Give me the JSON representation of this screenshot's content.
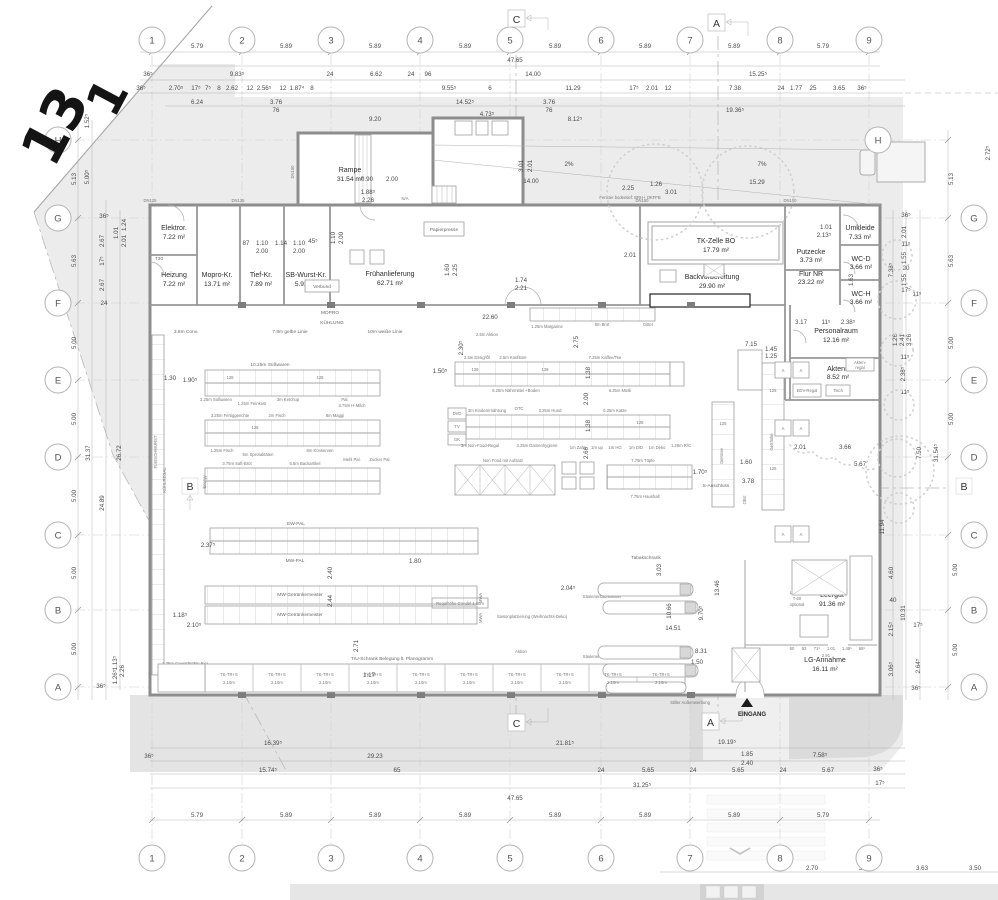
{
  "sheet": {
    "big_marks": [
      "13",
      "1"
    ],
    "markers": {
      "c": "C",
      "a": "A",
      "b": "B"
    },
    "entrance": "EINGANG",
    "notes": {
      "outdoor": "Stiller Außenwerbung",
      "fenster": "Fenster bodentief: BRH+ OKFFB",
      "dn125": "DN125",
      "dn150": "DN150",
      "t30": "T30",
      "na": "N/A"
    }
  },
  "grid": {
    "cols": [
      "1",
      "2",
      "3",
      "4",
      "5",
      "6",
      "7",
      "8",
      "9"
    ],
    "rows": [
      "H",
      "G",
      "F",
      "E",
      "D",
      "C",
      "B",
      "A"
    ]
  },
  "rooms": {
    "elektro": {
      "n": "Elektror.",
      "a": "7.22 m²"
    },
    "heizung": {
      "n": "Heizung",
      "a": "7.22 m²"
    },
    "mopro": {
      "n": "Mopro-Kr.",
      "a": "13.71 m²"
    },
    "tief": {
      "n": "Tief-Kr.",
      "a": "7.89 m²"
    },
    "sbwurst": {
      "n": "SB-Wurst-Kr.",
      "a": "5.92 m²"
    },
    "frueh": {
      "n": "Frühanlieferung",
      "a": "62.71 m²"
    },
    "rampe": {
      "n": "Rampe",
      "a": "31.54 m²"
    },
    "tkzelle": {
      "n": "TK-Zelle BO",
      "a": "17.79 m²"
    },
    "backvor": {
      "n": "Backvorbereitung",
      "a": "29.90 m²"
    },
    "putzecke": {
      "n": "Putzecke",
      "a": "3.73 m²"
    },
    "umkleide": {
      "n": "Umkleide",
      "a": "7.33 m²"
    },
    "wcd": {
      "n": "WC-D",
      "a": "3.66 m²"
    },
    "wch": {
      "n": "WC-H",
      "a": "3.66 m²"
    },
    "flur": {
      "n": "Flur NR",
      "a": "23.22 m²"
    },
    "personal": {
      "n": "Personalraum",
      "a": "12.16 m²"
    },
    "akten": {
      "n": "Aktenr.",
      "a": "8.52 m²"
    },
    "leergut": {
      "n": "Leergut",
      "a": "91.36 m²"
    },
    "lg": {
      "n": "LG-Annahme",
      "a": "16.11 m²"
    }
  },
  "fixtures": {
    "papierpresse": "Papierpresse",
    "verbund": "Verbund",
    "tabak": "Tabakschrank",
    "lg1": "Leergut",
    "lg2": "T-60",
    "lg3": "optional",
    "ar1": "Akten-",
    "ar2": "regal",
    "edv": "EDV-Regal",
    "tisch": "Tisch",
    "kuehlregal": "KÜHLREGAL",
    "fleischwurst": "FLEISCHWURST",
    "mwa": "MWA",
    "code128": "128",
    "code125": "125",
    "a": "A",
    "saeule": "Säulenersatzständer",
    "b_anschluss": "B-Anschluss",
    "s_anschluss": "S-Anschluss",
    "regalhoehe": "Regalhöhe Gondel 1.60m",
    "saison": "Saisonplatzierung (Weihnachts-Deko)",
    "aktion": "Aktion",
    "tru": "TrU-Schrank Belegung lt. Planogramm",
    "tk_cell": "TK-TR+S",
    "tk_len": "2.10m",
    "gewuerze": "1.25m Gewürze",
    "eier": "1.25m Eier",
    "getraenke": "Getränke",
    "gemuese": "Gemüse",
    "obst": "Obst",
    "energy": "Energy",
    "braun": "Braun",
    "dvd": "DVD",
    "tv": "TV",
    "gk": "GK"
  },
  "aisles": {
    "conv": "3.8m Conv.",
    "gelbe": "7.8m gelbe Linie",
    "weisse": "10m weiße Linie",
    "mopro": "MOPRO",
    "kuehlung": "KÜHLUNG",
    "suess1": "10.25m Süßwaren",
    "suess2": "3.25m Süßwaren",
    "feinkost": "1.25m Feinkost",
    "ketchup": "3m Ketchup",
    "hmilch": "3.75m H-Milch",
    "pal": "Pal.",
    "fertig": "3.25m Fertiggerichte",
    "fisch2": "2m Fisch",
    "maggi": "8m Maggi",
    "fisch": "1.25m Fisch",
    "spez": "5m Spezialitäten",
    "konserven": "8m Konserven",
    "saft": "3.75m Saft-Brot",
    "back": "6.5m Backartikel",
    "mehl": "Mehl Pal.",
    "zucker": "Zucker Pal.",
    "essig": "2.5m Essig/Öl",
    "konfituere": "2.5m Konfitüre",
    "kaffee": "7.25m Kaffee/Tee",
    "naehrmittel": "6.25m Nährmittel +Boden",
    "muesli": "6.25m Müsli",
    "kinder": "3m Kinderernährung",
    "otc": "OTC",
    "hund": "3.25m Hund",
    "katze": "6.25m Katze",
    "nonfood": "3m Non-Food-Regal",
    "damen": "3.25m Damenhygiene",
    "zahn": "1m Zahn",
    "up": "1m up",
    "hg": "1m HG",
    "dd": "1m D/D",
    "deko": "1m Deko",
    "rc": "1.25m R/C",
    "nonfood2": "Non Food mit Aufsatz",
    "toepfe": "7.75m Töpfe",
    "haushalt": "7.75m Haushalt",
    "margarine": "1.25m Margarine",
    "brot": "8m Brot",
    "gitter": "Gitter",
    "aktion25": "2.5m Aktion",
    "ewpal": "EW-PAL",
    "mwpal": "MW-PAL",
    "mwg": "MW-Getränkemeister"
  },
  "dims": {
    "gt": [
      "5.79",
      "5.89",
      "5.89",
      "5.89",
      "5.89",
      "5.89",
      "5.89",
      "5.79"
    ],
    "gb": [
      "5.79",
      "5.89",
      "5.89",
      "5.89",
      "5.89",
      "5.89",
      "5.89",
      "5.79"
    ],
    "w_total": "47.65",
    "t2": [
      "36⁵",
      "9.83⁵",
      "24",
      "6.62",
      "24",
      "96",
      "14.00",
      "15.25⁵"
    ],
    "t3": [
      "36⁵",
      "2.70⁵",
      "17⁵",
      "7⁵",
      "8",
      "2.62",
      "12",
      "2.56⁵",
      "12",
      "1.87⁴",
      "8",
      "9.55⁵",
      "6",
      "11.29",
      "17⁵",
      "2.01",
      "12",
      "7.38",
      "24",
      "1.77",
      "25",
      "3.65",
      "36⁵"
    ],
    "t4": [
      "6.24",
      "3.76",
      "76",
      "14.52⁵",
      "9.20",
      "4.73⁵",
      "3.76",
      "76",
      "8.12⁵",
      "19.36⁵"
    ],
    "ramp": [
      "2%",
      "7%",
      "14.00",
      "15.29",
      "2.25",
      "1.26",
      "3.01",
      "0.90",
      "2.00",
      "3.01",
      "2.01",
      "1.88⁵",
      "2.26",
      "1.74",
      "2.21",
      "1.60",
      "2.25"
    ],
    "doors": [
      "87",
      "1.10",
      "2.00",
      "1.14",
      "1.10",
      "2.00",
      "45⁵",
      "1.10",
      "2.00"
    ],
    "lv": [
      "1.52⁵",
      "5.13",
      "5.00⁵",
      "5.63",
      "5.00",
      "5.00",
      "5.00",
      "5.00",
      "5.00"
    ],
    "lv2": [
      "36⁵",
      "2.67",
      "1.01",
      "1.24",
      "2.01",
      "17⁵",
      "2.67",
      "24",
      "31.37",
      "26.72",
      "24.89",
      "36⁵",
      "1.26⁵",
      "1.13⁵",
      "2.26"
    ],
    "rv": [
      "2.72⁵",
      "5.13",
      "5.63",
      "5.00",
      "5.00",
      "5.00",
      "5.00"
    ],
    "rv2": [
      "36⁵",
      "2.01",
      "11⁵",
      "1.55",
      "30",
      "1.55",
      "17⁵",
      "11⁵",
      "7.38⁵",
      "1.26",
      "2.41",
      "3.26",
      "11⁵",
      "2.38⁵",
      "11⁵",
      "31.54⁵",
      "7.50",
      "11.94",
      "4.60",
      "40",
      "10.31",
      "2.15⁵",
      "17⁵",
      "3.06⁵",
      "2.64⁵",
      "36⁵"
    ],
    "b1": [
      "16.39⁵",
      "21.81⁵",
      "19.19⁵",
      "36⁵",
      "29.23",
      "1.85",
      "2.40",
      "7.58⁵",
      "15.74⁵",
      "65",
      "24",
      "5.65",
      "24",
      "5.65",
      "24",
      "5.67",
      "36⁵",
      "31.25⁵",
      "17⁵",
      "47.65"
    ],
    "b2": [
      "2.70",
      "3.89",
      "3.63",
      "3.50"
    ],
    "lgc": [
      "60",
      "93",
      "71⁵",
      "1.01",
      "1.48⁵",
      "68⁵",
      "2.91"
    ],
    "in": [
      "22.60",
      "2.75",
      "2.30⁵",
      "1.38",
      "2.00",
      "1.38",
      "2.66",
      "1.30",
      "1.90⁵",
      "1.50⁵",
      "7.15",
      "1.45",
      "1.25",
      "2.01",
      "3.66",
      "5.67",
      "1.60",
      "3.78",
      "1.70⁵",
      "1.80",
      "2.40",
      "2.44",
      "2.71",
      "2.37⁵",
      "2.10⁵",
      "1.18⁵",
      "14.51",
      "13.46",
      "9.70⁵",
      "10.66",
      "8.31",
      "1.50",
      "2.04⁵",
      "3.03",
      "1.17",
      "1.63",
      "3.17",
      "11⁵",
      "2.38⁵",
      "1.01",
      "2.13⁵",
      "2.01"
    ]
  }
}
